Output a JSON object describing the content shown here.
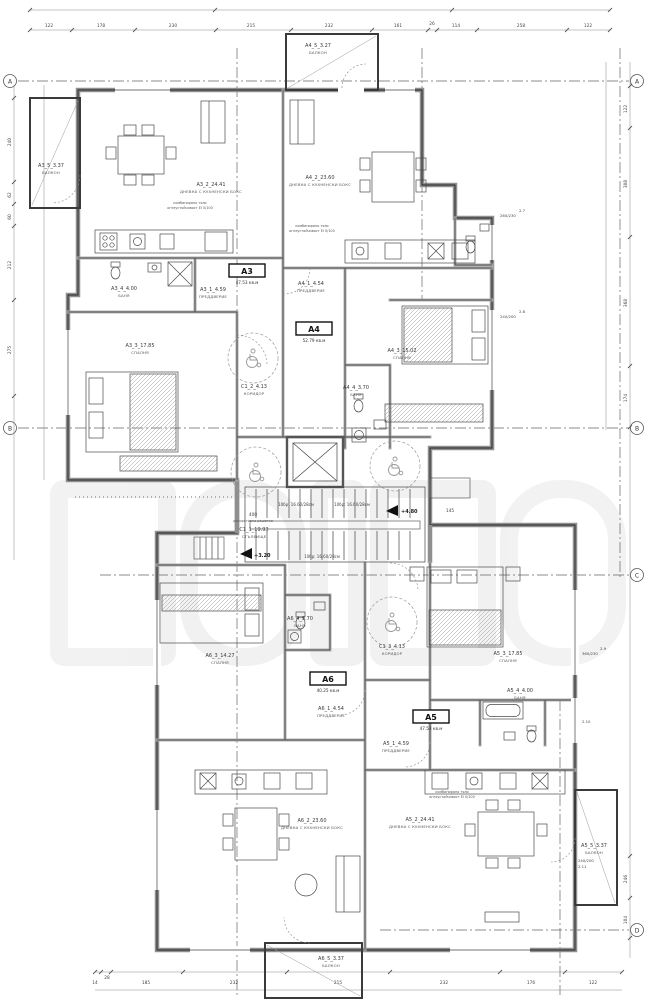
{
  "plan": {
    "grid": {
      "r1": "A",
      "r2": "B",
      "r3": "C",
      "r4": "D"
    },
    "levels": {
      "upper": "+4.80",
      "mid": "+3.20"
    },
    "stairs_note": "10бр: 16.60/28см",
    "core": {
      "staircase": {
        "code": "С1_1_19.93",
        "name": "СТЪЛБИЩЕ"
      },
      "corridor_upper": {
        "code": "С1_2_4.13",
        "name": "КОРИДОР"
      },
      "corridor_lower": {
        "code": "С1_3_4.13",
        "name": "КОРИДОР"
      }
    },
    "apartments": {
      "a3": {
        "id": "А3",
        "area": "47.53 кв.м",
        "rooms": {
          "entry": {
            "code": "А3_1_4.59",
            "name": "ПРЕДДВЕРИЕ"
          },
          "living": {
            "code": "А3_2_24.41",
            "name": "ДНЕВНА С КУХНЕНСКИ БОКС"
          },
          "bedroom": {
            "code": "А3_3_17.85",
            "name": "СПАЛНЯ"
          },
          "bath": {
            "code": "А3_4_4.00",
            "name": "БАНЯ"
          },
          "balcony": {
            "code": "А3_5_3.37",
            "name": "БАЛКОН"
          }
        }
      },
      "a4": {
        "id": "А4",
        "area": "52.79 кв.м",
        "rooms": {
          "entry": {
            "code": "А4_1_4.54",
            "name": "ПРЕДДВЕРИЕ"
          },
          "living": {
            "code": "А4_2_23.60",
            "name": "ДНЕВНА С КУХНЕНСКИ БОКС"
          },
          "bedroom": {
            "code": "А4_3_15.02",
            "name": "СПАЛНЯ"
          },
          "bath": {
            "code": "А4_4_3.70",
            "name": "БАНЯ"
          },
          "balcony": {
            "code": "А4_5_3.27",
            "name": "БАЛКОН"
          }
        }
      },
      "a5": {
        "id": "А5",
        "area": "47.53 кв.м",
        "rooms": {
          "entry": {
            "code": "А5_1_4.59",
            "name": "ПРЕДДВЕРИЕ"
          },
          "living": {
            "code": "А5_2_24.41",
            "name": "ДНЕВНА С КУХНЕНСКИ БОКС"
          },
          "bedroom": {
            "code": "А5_3_17.85",
            "name": "СПАЛНЯ"
          },
          "bath": {
            "code": "А5_4_4.00",
            "name": "БАНЯ"
          },
          "balcony": {
            "code": "А5_5_3.37",
            "name": "БАЛКОН"
          }
        }
      },
      "a6": {
        "id": "А6",
        "area": "40.25 кв.м",
        "rooms": {
          "entry": {
            "code": "А6_1_4.54",
            "name": "ПРЕДДВЕРИЕ"
          },
          "living": {
            "code": "А6_2_23.60",
            "name": "ДНЕВНА С КУХНЕНСКИ БОКС"
          },
          "bedroom": {
            "code": "А6_3_14.27",
            "name": "СПАЛНЯ"
          },
          "bath": {
            "code": "А6_4_3.70",
            "name": "БАНЯ"
          },
          "balcony": {
            "code": "А6_5_3.37",
            "name": "БАЛКОН"
          }
        }
      }
    },
    "windows": {
      "w27": {
        "tag": "2.7",
        "size": "260/230"
      },
      "w28": {
        "tag": "2.8",
        "size": "240/200"
      },
      "w29": {
        "tag": "2.9",
        "size": "360/230"
      },
      "w210": {
        "tag": "2.10",
        "size": ""
      },
      "w211": {
        "tag": "2.11",
        "size": "240/200"
      }
    },
    "notes": {
      "fire1": "комбинирано тяло",
      "fire2": "огнеустойчивост EI 0/100",
      "grille": "декоративна решетка"
    },
    "dims": {
      "top": [
        "122",
        "178",
        "230",
        "215",
        "232",
        "161",
        "26",
        "114",
        "258",
        "122"
      ],
      "bottom": [
        "14",
        "28",
        "185",
        "232",
        "215",
        "232",
        "176",
        "122"
      ],
      "left": [
        "240",
        "62",
        "60",
        "212",
        "275"
      ],
      "right": [
        "122",
        "308",
        "368",
        "174",
        "246",
        "104"
      ],
      "interior": {
        "grille_len": "400",
        "porch": "145"
      }
    }
  }
}
